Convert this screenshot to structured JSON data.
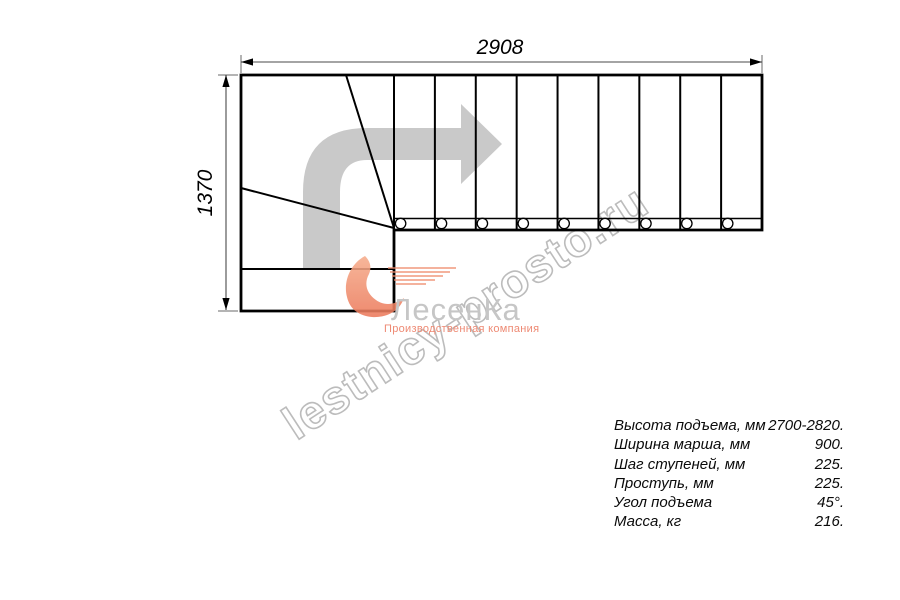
{
  "dimensions": {
    "width_mm": "2908",
    "height_mm": "1370"
  },
  "drawing": {
    "straight_steps": 9,
    "flight_x_start": 394,
    "flight_x_end": 762,
    "flight_y_top": 75,
    "flight_y_bottom": 230,
    "fastener_row_y": 223.5,
    "arrow_color": "#c9c9c9",
    "line_color": "#000000"
  },
  "watermark": {
    "text": "lestnicy-prosto.ru",
    "color": "#bcbcbc"
  },
  "logo": {
    "brand": "ЛесенКа",
    "subtitle": "Производственная компания",
    "brand_color": "#c6c6c6",
    "accent_color": "#ee8266"
  },
  "specs": {
    "rows": [
      {
        "label": "Высота подъема, мм",
        "value": "2700-2820."
      },
      {
        "label": "Ширина марша, мм",
        "value": "900."
      },
      {
        "label": "Шаг ступеней, мм",
        "value": "225."
      },
      {
        "label": "Проступь, мм",
        "value": "225."
      },
      {
        "label": "Угол подъема",
        "value": "45°."
      },
      {
        "label": "Масса, кг",
        "value": "216."
      }
    ]
  }
}
